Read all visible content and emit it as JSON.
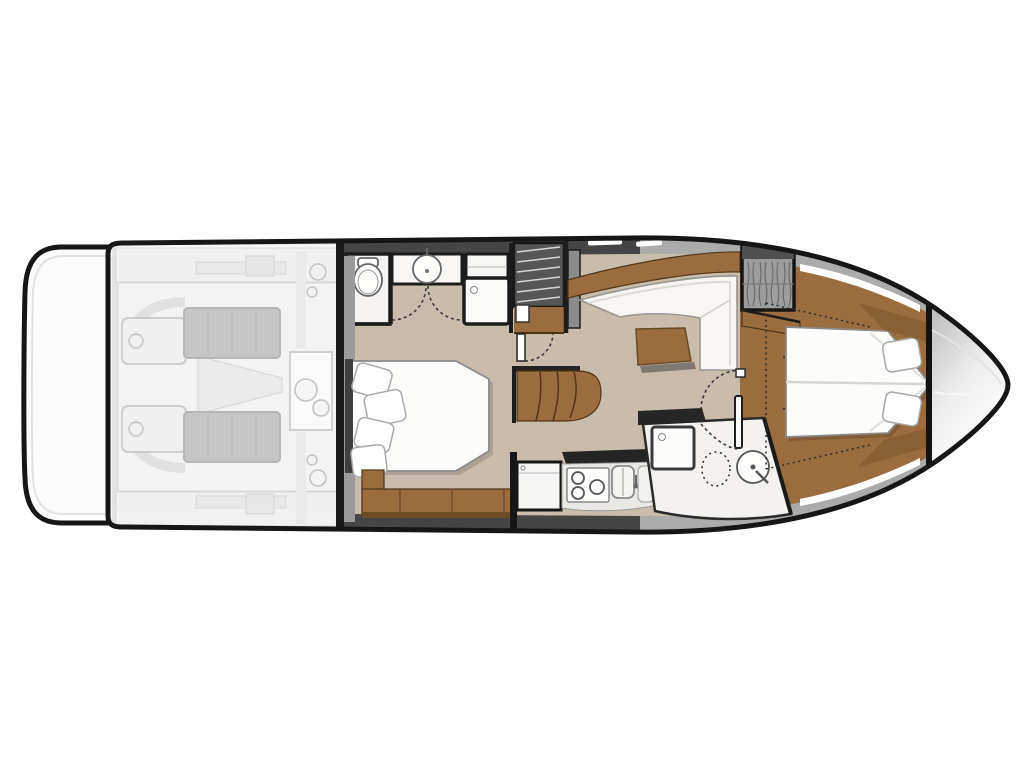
{
  "title": "Motor yacht lower-deck floor plan (no visible text in image)",
  "palette": {
    "hull_outline": "#161616",
    "floor": "#c9bcab",
    "wood": "#9a6c3e",
    "wood_dark": "#6d4b27",
    "wall": "#1a1a1a",
    "band_dark": "#454545",
    "band_light": "#ababab",
    "upholstery": "#f7f6f3",
    "bed_white": "#fcfcfb",
    "engine_dark": "#8e8e8e",
    "engine_faded_bg": "#efefef",
    "bow_shade": "#b8b8b8",
    "bathroom_floor": "#f3f2ef"
  },
  "floorplan": {
    "vessel": "motor yacht, top-down lower deck plan, bow pointing right",
    "regions": [
      {
        "id": "swim-platform",
        "label": "swim platform (aft, far left)"
      },
      {
        "id": "engine-room",
        "label": "engine room shown faded/translucent",
        "features": [
          "twin engines",
          "gearboxes",
          "steering gear box",
          "exhaust hoses"
        ]
      },
      {
        "id": "midship-cabin",
        "label": "midship guest cabin",
        "features": [
          "double bed",
          "4 pillows",
          "headboard",
          "storage bench",
          "curved wooden steps"
        ]
      },
      {
        "id": "ensuite-head",
        "label": "head compartment (top)",
        "features": [
          "toilet",
          "washbasin vanity",
          "storage cabinet",
          "shower cabin with drain"
        ]
      },
      {
        "id": "companionway",
        "label": "staircase from main deck",
        "features": [
          "dark upper flight with treads",
          "wood landing"
        ]
      },
      {
        "id": "salon",
        "label": "lower salon / dinette",
        "features": [
          "L-shaped white sofa",
          "wood coffee table"
        ]
      },
      {
        "id": "galley",
        "label": "galley (bottom centre)",
        "features": [
          "refrigerator",
          "cooktop with 3 burners",
          "double sink with faucet",
          "tall cabinet"
        ]
      },
      {
        "id": "day-head",
        "label": "forward bathroom (bottom right)",
        "features": [
          "shower cabin with drain",
          "toilet (dotted outline)",
          "round washbasin with mixer"
        ]
      },
      {
        "id": "forward-cabin",
        "label": "forward owner cabin",
        "features": [
          "island V-berth pointing to bow",
          "2 pillows",
          "hanging locker with clothes",
          "wood side shelves"
        ]
      },
      {
        "id": "bow-deck",
        "label": "bow deck beyond forward bulkhead"
      }
    ],
    "annotations": {
      "door_swings": "dashed quarter-circle arcs at head, cabin and bathroom doors",
      "deck_outline": "dotted projection lines across the forward cabin and berth",
      "burner_count": 3,
      "pillow_count_midship": 4,
      "pillow_count_forward": 2
    }
  }
}
